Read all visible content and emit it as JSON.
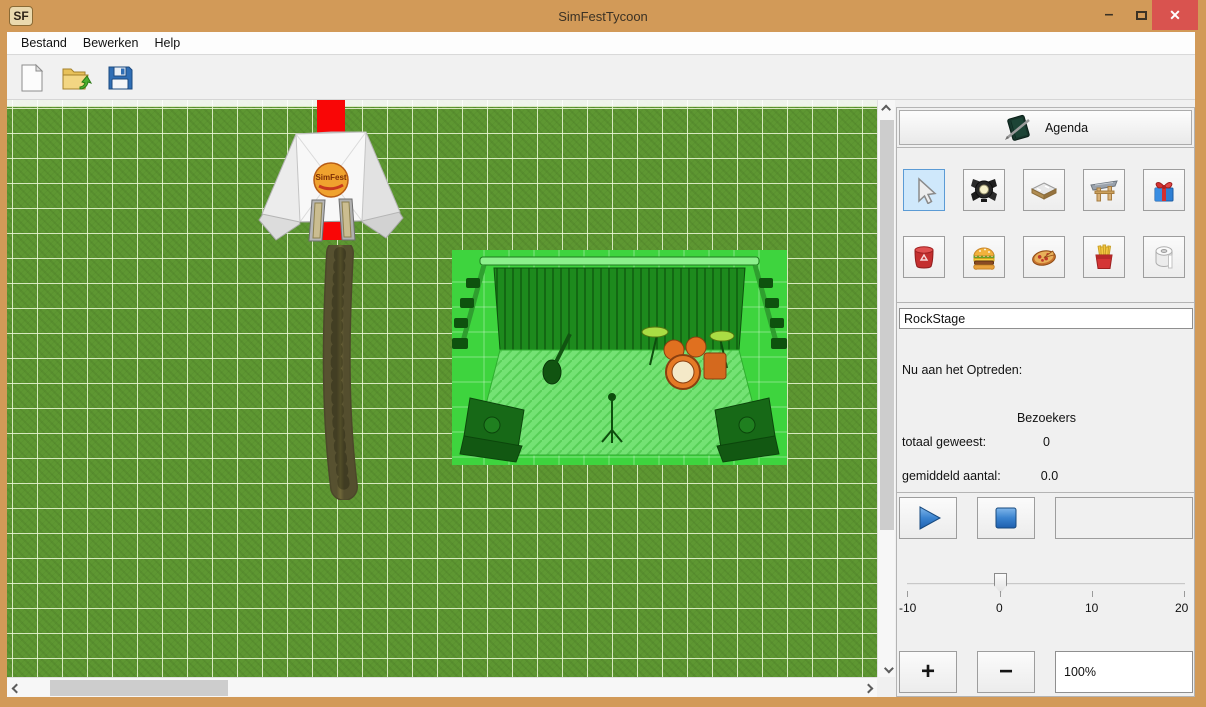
{
  "window": {
    "logo": "SF",
    "title": "SimFestTycoon",
    "controls": {
      "minimize": "–",
      "close": "✕"
    }
  },
  "menu": {
    "items": [
      "Bestand",
      "Bewerken",
      "Help"
    ]
  },
  "toolbar": {
    "buttons": [
      "new-file",
      "open-file",
      "save-file"
    ]
  },
  "canvas": {
    "tent_logo": "SimFest",
    "objects": [
      "entrance-tent",
      "red-carpet",
      "dirt-path",
      "stage-selected"
    ]
  },
  "right_panel": {
    "agenda_button": "Agenda",
    "tools_row1": [
      "select",
      "spotlight",
      "road",
      "entrance",
      "gift"
    ],
    "tools_row2": [
      "trash-bin",
      "burger",
      "pizza",
      "fries",
      "toilet-paper"
    ],
    "stage_name": "RockStage",
    "now_performing_label": "Nu aan het Optreden:",
    "visitors_header": "Bezoekers",
    "total_label": "totaal geweest:",
    "total_value": "0",
    "average_label": "gemiddeld aantal:",
    "average_value": "0.0",
    "slider": {
      "min": -10,
      "max": 20,
      "value": 0,
      "labels": [
        "-10",
        "0",
        "10",
        "20"
      ]
    },
    "zoom_plus": "+",
    "zoom_minus": "−",
    "zoom_value": "100%"
  },
  "colors": {
    "titlebar": "#d29a58",
    "close_button": "#d9534f",
    "selected_tool_bg": "#cfe8fb",
    "selected_tool_border": "#5b9bd5",
    "stage_highlight": "#3ed43e",
    "carpet_red": "#f90606",
    "grid_green": "#5e9732"
  }
}
